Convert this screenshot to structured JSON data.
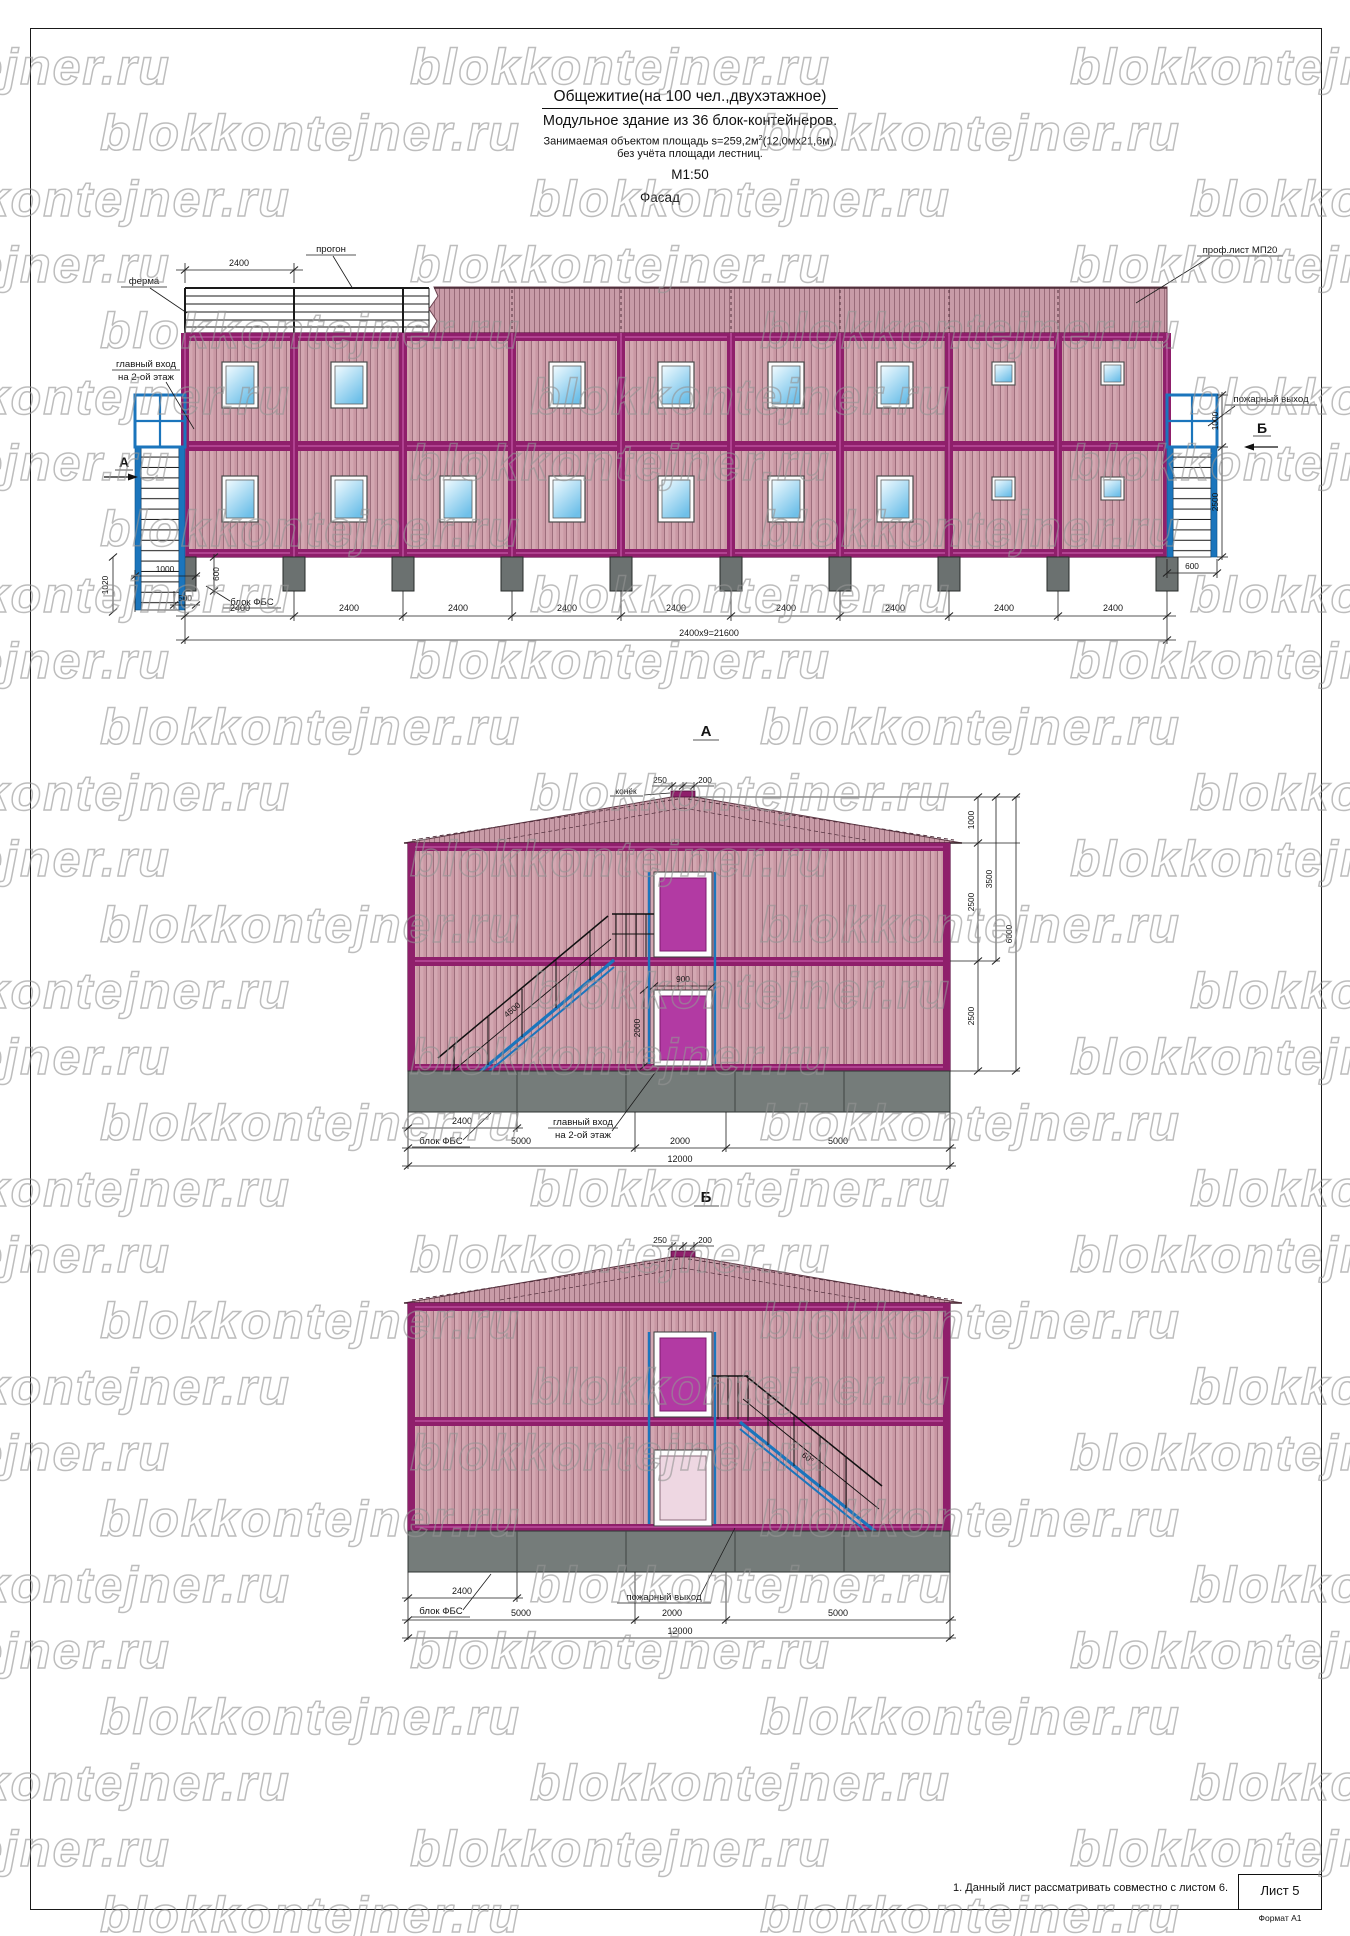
{
  "watermark": {
    "text": "blokkontejner.ru"
  },
  "title": {
    "line1": "Общежитие(на 100 чел.,двухэтажное)",
    "line2": "Модульное  здание из 36 блок-контейнеров.",
    "line3a": "Занимаемая объектом площадь   s=259,2м",
    "line3sup": "2",
    "line3b": "(12,0мх21,6м),",
    "line4": "без учёта площади лестниц.",
    "scale": "М1:50",
    "view_facade": "Фасад"
  },
  "facade": {
    "labels": {
      "truss": "ферма",
      "purlin": "прогон",
      "roof_sheet": "проф.лист МП20",
      "entrance_l1": "главный вход",
      "entrance_l2": "на 2-ой этаж",
      "fire_exit": "пожарный выход",
      "fbs_block": "блок ФБС",
      "marker_a": "А",
      "marker_b": "Б"
    },
    "dims": {
      "module": "2400",
      "total": "2400х9=21600",
      "top": "2400",
      "stair_offset": "1000",
      "block_h": "600",
      "block_w": "500",
      "left_stair": "1020",
      "right_top": "1000",
      "right_stair_h": "2500",
      "right_stair_w": "600"
    }
  },
  "view_a": {
    "title": "А",
    "labels": {
      "ridge": "конёк",
      "entrance_l1": "главный вход",
      "entrance_l2": "на 2-ой этаж",
      "fbs_block": "блок ФБС"
    },
    "dims": {
      "ridge_l": "250",
      "ridge_r": "200",
      "roof_h": "1000",
      "to_ridge": "3500",
      "upper_h": "2500",
      "total_h": "6000",
      "lower_h": "2500",
      "stair": "4500",
      "door_w": "900",
      "door_h": "2000",
      "fbs": "2400",
      "left": "5000",
      "mid": "2000",
      "right": "5000",
      "total_w": "12000"
    }
  },
  "view_b": {
    "title": "Б",
    "labels": {
      "fire_exit": "пожарный выход",
      "fbs_block": "блок ФБС"
    },
    "dims": {
      "ridge_l": "250",
      "ridge_r": "200",
      "stair_angle": "60°",
      "fbs": "2400",
      "left": "5000",
      "mid": "2000",
      "right": "5000",
      "total_w": "12000"
    }
  },
  "footer": {
    "note": "1. Данный лист рассматривать совместно с листом 6.",
    "sheet": "Лист 5",
    "format": "Формат А1"
  },
  "colors": {
    "frame_magenta": "#8f1f6b",
    "siding_pink": "#c998a4",
    "stair_blue": "#1b75bc",
    "window_blue": "#70c2e9",
    "door_magenta": "#b23aa3",
    "foundation_grey": "#6b7170"
  }
}
